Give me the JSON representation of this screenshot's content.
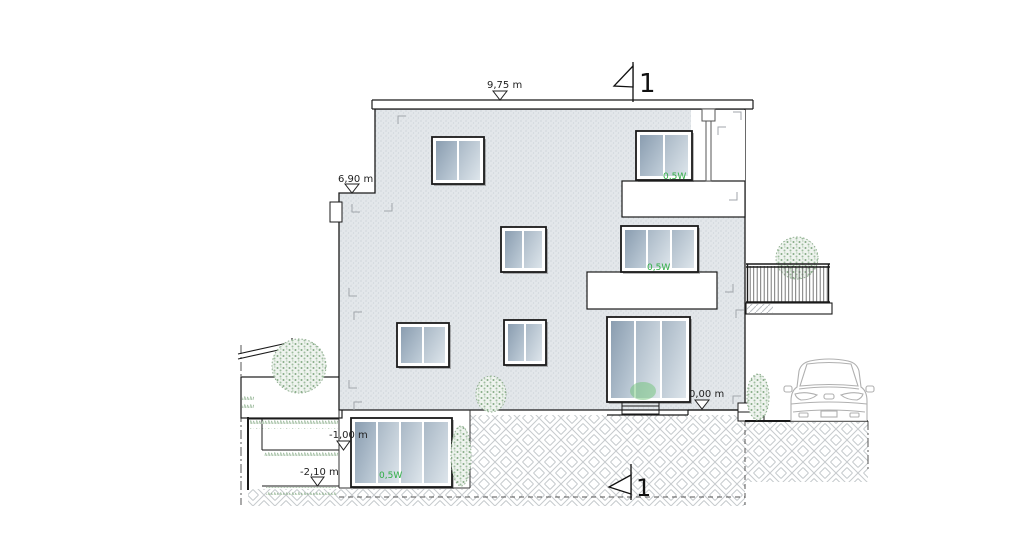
{
  "drawing": {
    "kind": "building elevation section drawing",
    "background": "#ffffff"
  },
  "labels": {
    "roof_level": "9,75 m",
    "upper_level": "6,90 m",
    "ground_level": "0,00 m",
    "terrace_level": "-1,00 m",
    "basement_level": "-2,10 m"
  },
  "section_markers": {
    "top": "1",
    "bottom": "1"
  },
  "window_tags": {
    "attic": "0,5W",
    "second_floor": "0,5W",
    "basement": "0,5W"
  },
  "colors": {
    "facade": "#e3e7ea",
    "outline": "#1a1a1a",
    "glass_light": "#dde5eb",
    "glass_dark": "#8a9db0",
    "window_tag_green": "#2fae44",
    "vegetation": "#86ab86",
    "ground_hatch": "#c6cacd",
    "car_outline": "#b0b0b0"
  }
}
